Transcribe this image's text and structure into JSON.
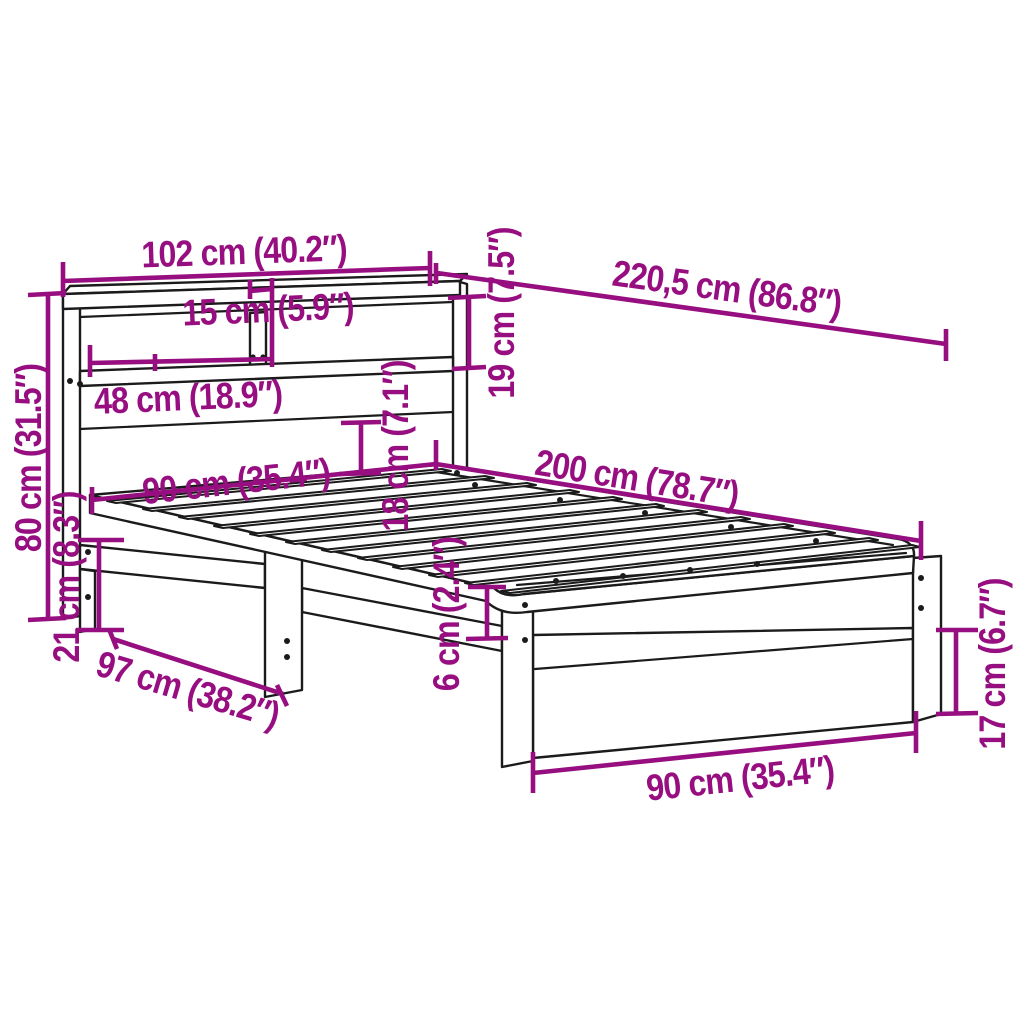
{
  "figure": {
    "title": "Bookshelf bed frame with slatted base — dimension diagram",
    "accent_color": "#970E80",
    "line_color": "#1B1B1B",
    "background_color": "#FFFFFF",
    "slat_count": 12,
    "unit_style": "centimetres with inches in parentheses"
  },
  "dims": {
    "headboard_width": "102 cm (40.2″)",
    "shelf_depth": "15 cm (5.9″)",
    "total_length": "220,5 cm (86.8″)",
    "shelf_height": "19 cm (7.5″)",
    "compartment_width": "48 cm (18.9″)",
    "headboard_height": "80 cm (31.5″)",
    "panel_height": "18 cm (7.1″)",
    "bed_length": "200 cm (78.7″)",
    "bed_width_head": "90 cm (35.4″)",
    "rail_height": "21 cm (8.3″)",
    "base_depth": "97 cm (38.2″)",
    "slat_clearance": "6 cm (2.4″)",
    "leg_height": "17 cm (6.7″)",
    "bed_width_foot": "90 cm (35.4″)"
  }
}
